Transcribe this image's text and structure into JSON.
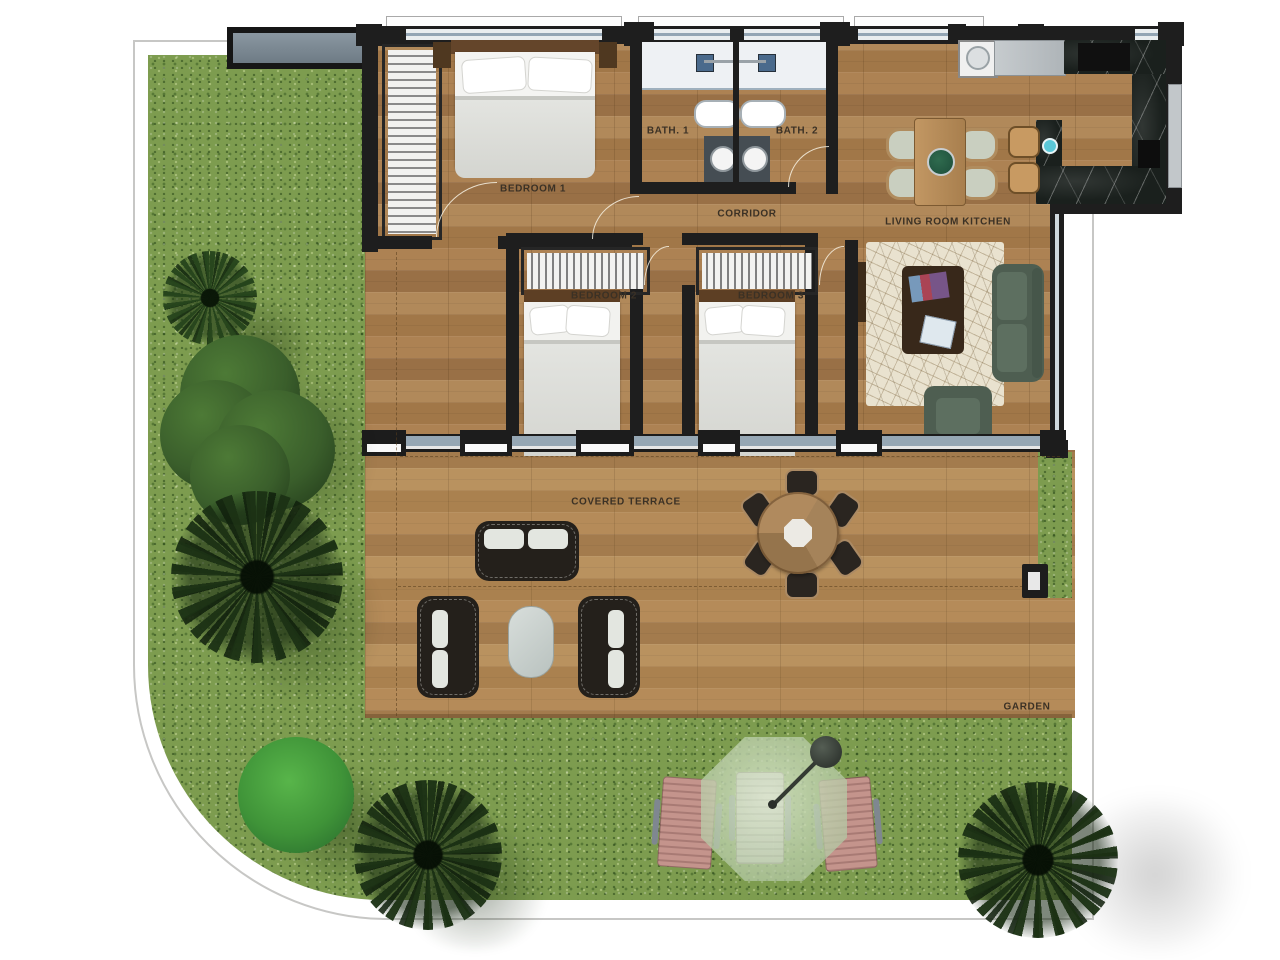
{
  "plan": {
    "rooms": [
      {
        "id": "bedroom-1",
        "label": "BEDROOM 1"
      },
      {
        "id": "bath-1",
        "label": "BATH. 1"
      },
      {
        "id": "bath-2",
        "label": "BATH. 2"
      },
      {
        "id": "corridor",
        "label": "CORRIDOR"
      },
      {
        "id": "living-room-kitchen",
        "label": "LIVING ROOM KITCHEN"
      },
      {
        "id": "bedroom-2",
        "label": "BEDROOM 2"
      },
      {
        "id": "bedroom-3",
        "label": "BEDROOM 3"
      },
      {
        "id": "covered-terrace",
        "label": "COVERED TERRACE"
      },
      {
        "id": "garden",
        "label": "GARDEN"
      }
    ]
  },
  "colors": {
    "grass": "#7d9c4f",
    "wood": "#a87e4e",
    "wall": "#1e1e1e",
    "marble": "#1a201d",
    "glass": "#96a7b4",
    "rug": "#e9e2cf",
    "sofa": "#4e5e51",
    "outdoor": "#24201b",
    "lounger": "#bb8c84",
    "canopy": "#c6d8b6",
    "label": "#3b3125"
  }
}
